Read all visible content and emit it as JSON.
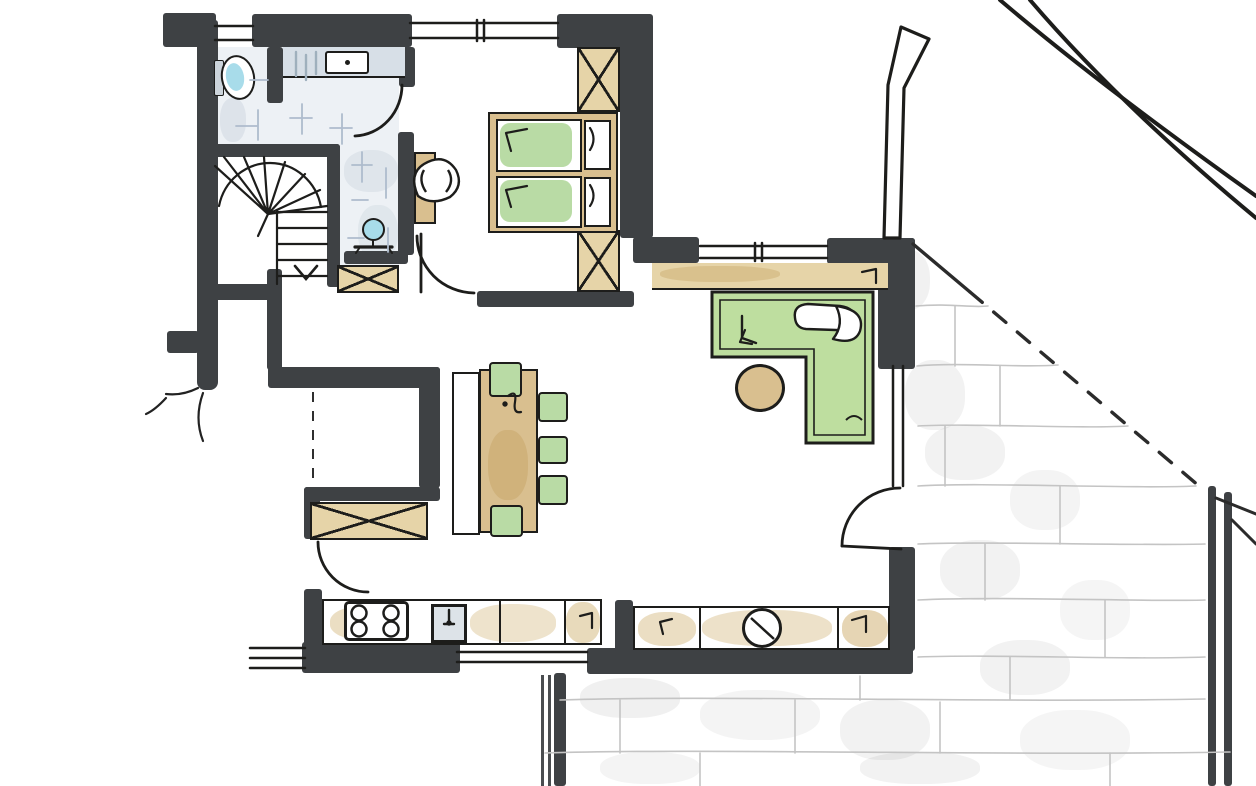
{
  "meta": {
    "title": "Hand-drawn architectural floor plan sketch",
    "style": "marker and ink drawing, top view"
  },
  "palette": {
    "paper": "#ffffff",
    "wall": "#3e4144",
    "line": "#1d1d1b",
    "tan": "#d9bf8f",
    "tan_light": "#e6d4a8",
    "green": "#b9dba5",
    "green_light": "#d2e8c4",
    "blue": "#a8dcea",
    "tile": "#edf1f5",
    "tile_line": "#aebccd",
    "stone_line": "#c4c4c4"
  },
  "rooms": {
    "bathroom": {
      "label": "Bathroom with WC and vanity, tiled floor"
    },
    "staircase": {
      "label": "Winder staircase with direction arrow"
    },
    "hallway": {
      "label": "Entrance hall with built-in closet"
    },
    "bedroom": {
      "label": "Bedroom with double bed and wardrobes"
    },
    "study": {
      "label": "Study corner with L-shaped desk"
    },
    "dining": {
      "label": "Dining area with table, bench and chairs"
    },
    "kitchen": {
      "label": "Kitchen with counters along the south wall"
    },
    "terrace": {
      "label": "Stone-paved terrace under roof overhang"
    }
  },
  "furniture": {
    "toilet": {
      "label": "Toilet"
    },
    "vanity": {
      "label": "Vanity counter with washbasin"
    },
    "handbasin": {
      "label": "Small round washbasin on stand"
    },
    "stairs": {
      "label": "Winder stairs"
    },
    "wardrobe_top": {
      "label": "Built-in wardrobe (crossed box)"
    },
    "wardrobe_bot": {
      "label": "Built-in wardrobe (crossed box)"
    },
    "shaft": {
      "label": "Built-in closet / shaft (crossed box)"
    },
    "hall_closet": {
      "label": "Hall closet bench (crossed box)"
    },
    "bed": {
      "label": "Double bed, two mattresses with green covers and pillows"
    },
    "bedroom_desk": {
      "label": "Small desk"
    },
    "bedroom_chair": {
      "label": "Chair"
    },
    "desk": {
      "label": "L-shaped desk with green top"
    },
    "office_chair": {
      "label": "Swivel chair"
    },
    "pouf": {
      "label": "Round pouf"
    },
    "sideboard": {
      "label": "Sideboard under window"
    },
    "bench": {
      "label": "Dining bench"
    },
    "table": {
      "label": "Dining table"
    },
    "chairs": {
      "label": "Dining chairs with green seats"
    },
    "cooktop": {
      "label": "Four-burner cooktop"
    },
    "sink": {
      "label": "Kitchen sink with tap"
    },
    "round_sink": {
      "label": "Round basin in island counter"
    },
    "slider": {
      "label": "Sliding glass door to terrace"
    },
    "terrace_door": {
      "label": "Glass door to terrace"
    },
    "post": {
      "label": "Terrace roof post with railing"
    }
  },
  "doors": {
    "bath": {
      "label": "Bathroom door swing"
    },
    "bedroom": {
      "label": "Bedroom door swing"
    },
    "hall": {
      "label": "Hall to kitchen door swing"
    },
    "terrace": {
      "label": "Living room terrace door swing"
    }
  }
}
